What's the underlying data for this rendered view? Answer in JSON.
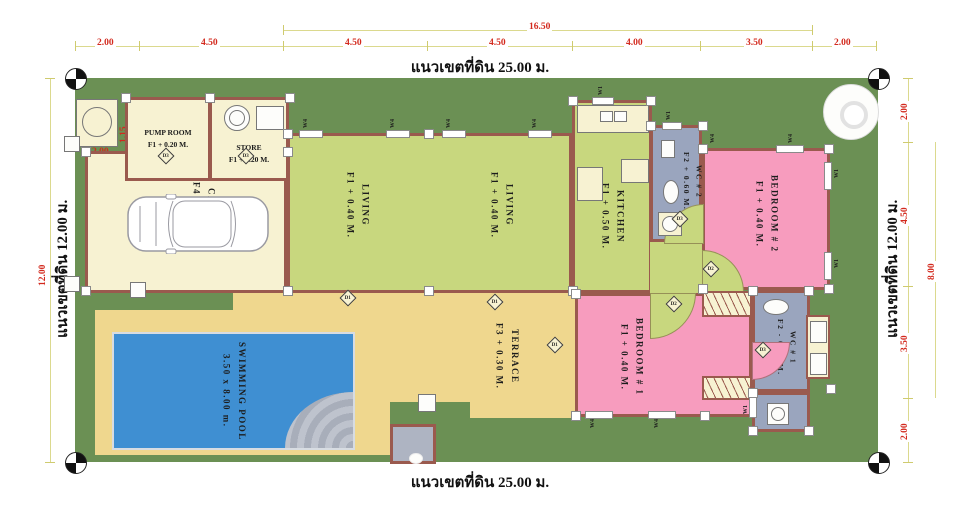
{
  "site": {
    "top_boundary": "แนวเขตที่ดิน 25.00 ม.",
    "bottom_boundary": "แนวเขตที่ดิน 25.00 ม.",
    "left_boundary": "แนวเขตที่ดิน 12.00 ม.",
    "right_boundary": "แนวเขตที่ดิน 12.00 ม."
  },
  "dims": {
    "top_overall": "16.50",
    "top": [
      "2.00",
      "4.50",
      "4.50",
      "4.50",
      "4.00",
      "3.50",
      "2.00"
    ],
    "right": [
      "2.00",
      "4.50",
      "3.50",
      "2.00"
    ],
    "right_span": "8.00",
    "left_span": "12.00",
    "carpark_entry": "2.00",
    "pump_offset": "1.15"
  },
  "rooms": {
    "pump": {
      "name": "PUMP ROOM",
      "level": "F1  +  0.20 M."
    },
    "store": {
      "name": "STORE",
      "level": "F1  +  0.20 M."
    },
    "carpark": {
      "name": "CARPARK",
      "level": "F4  +  0.25 M."
    },
    "living1": {
      "name": "LIVING",
      "level": "F1  +  0.40 M."
    },
    "living2": {
      "name": "LIVING",
      "level": "F1  +  0.40 M."
    },
    "kitchen": {
      "name": "KITCHEN",
      "level": "F1  +  0.50 M."
    },
    "wc2": {
      "name": "WC # 2",
      "level": "F2  +  0.60 M."
    },
    "bedroom2": {
      "name": "BEDROOM # 2",
      "level": "F1  +  0.40 M."
    },
    "bedroom1": {
      "name": "BEDROOM # 1",
      "level": "F1  +  0.40 M."
    },
    "wc1": {
      "name": "WC # 1",
      "level": "F2  -  0.60 M."
    },
    "terrace": {
      "name": "TERRACE",
      "level": "F3  +  0.30 M."
    },
    "pool": {
      "name": "SWIMMING POOL",
      "level": "3.50 x 8.00 m."
    }
  },
  "doors": {
    "d1": "D1",
    "d2": "D2",
    "d3": "D3"
  },
  "windows": {
    "w1": "W1",
    "w4": "W4"
  },
  "colors": {
    "land": "#6B9054",
    "wall": "#9A5A4E",
    "cream_floor": "#F7F2D2",
    "living_floor": "#C8D77E",
    "bedroom_floor": "#F79CBE",
    "terrace_floor": "#EFD78E",
    "pool_water": "#3F8FD2",
    "wc_floor": "#9AA5BE",
    "dimension_text": "#D3291D"
  }
}
